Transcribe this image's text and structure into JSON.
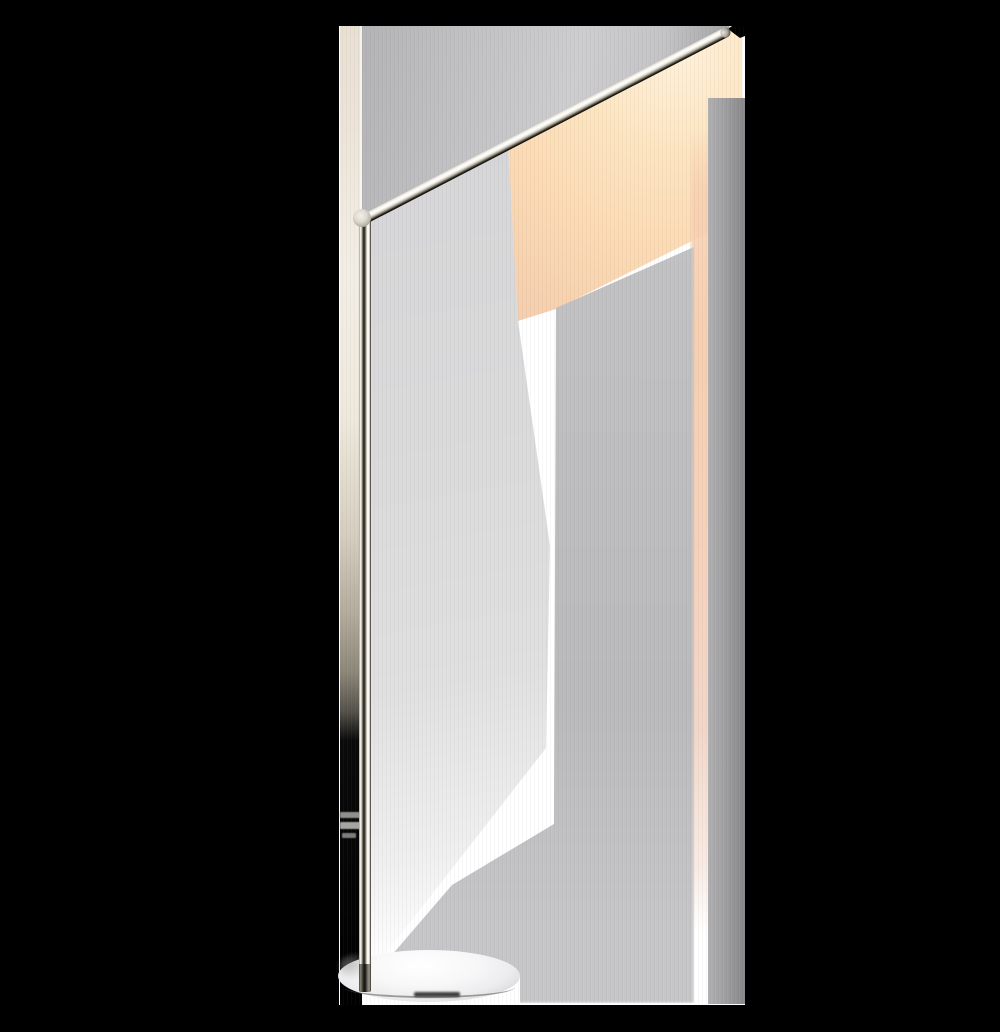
{
  "scene": {
    "type": "product photograph",
    "subject": "Minimalist angled-arm LED floor lamp",
    "subject_label": "Polished nickel floor lamp with angled linear LED arm, illuminated, casting warm glow and grey shadows on a white wall",
    "background": "black panels flanking a white studio wall",
    "lighting_state": "on",
    "parts": {
      "arm": "thin angled LED arm tube",
      "arm_tip": "rounded metal end cap",
      "joint": "cylindrical elbow end-cap disc",
      "pole": "slim vertical polished stem",
      "base": "round flat polished disc base"
    }
  },
  "palette": {
    "backdrop": "#000000",
    "wall_white": "#ffffff",
    "wall_cream_edge": "#ece4d8",
    "shadow_light": "#dbdbdc",
    "shadow_medium": "#bbbbbd",
    "shadow_dark_strip": "#919193",
    "glow_bright": "#fff2dd",
    "glow_warm": "#fcdcb6",
    "glow_band": "#f7cfb1",
    "metal_highlight": "#ffffff",
    "metal_shadow": "#161510",
    "base_chrome": "#ececee"
  }
}
